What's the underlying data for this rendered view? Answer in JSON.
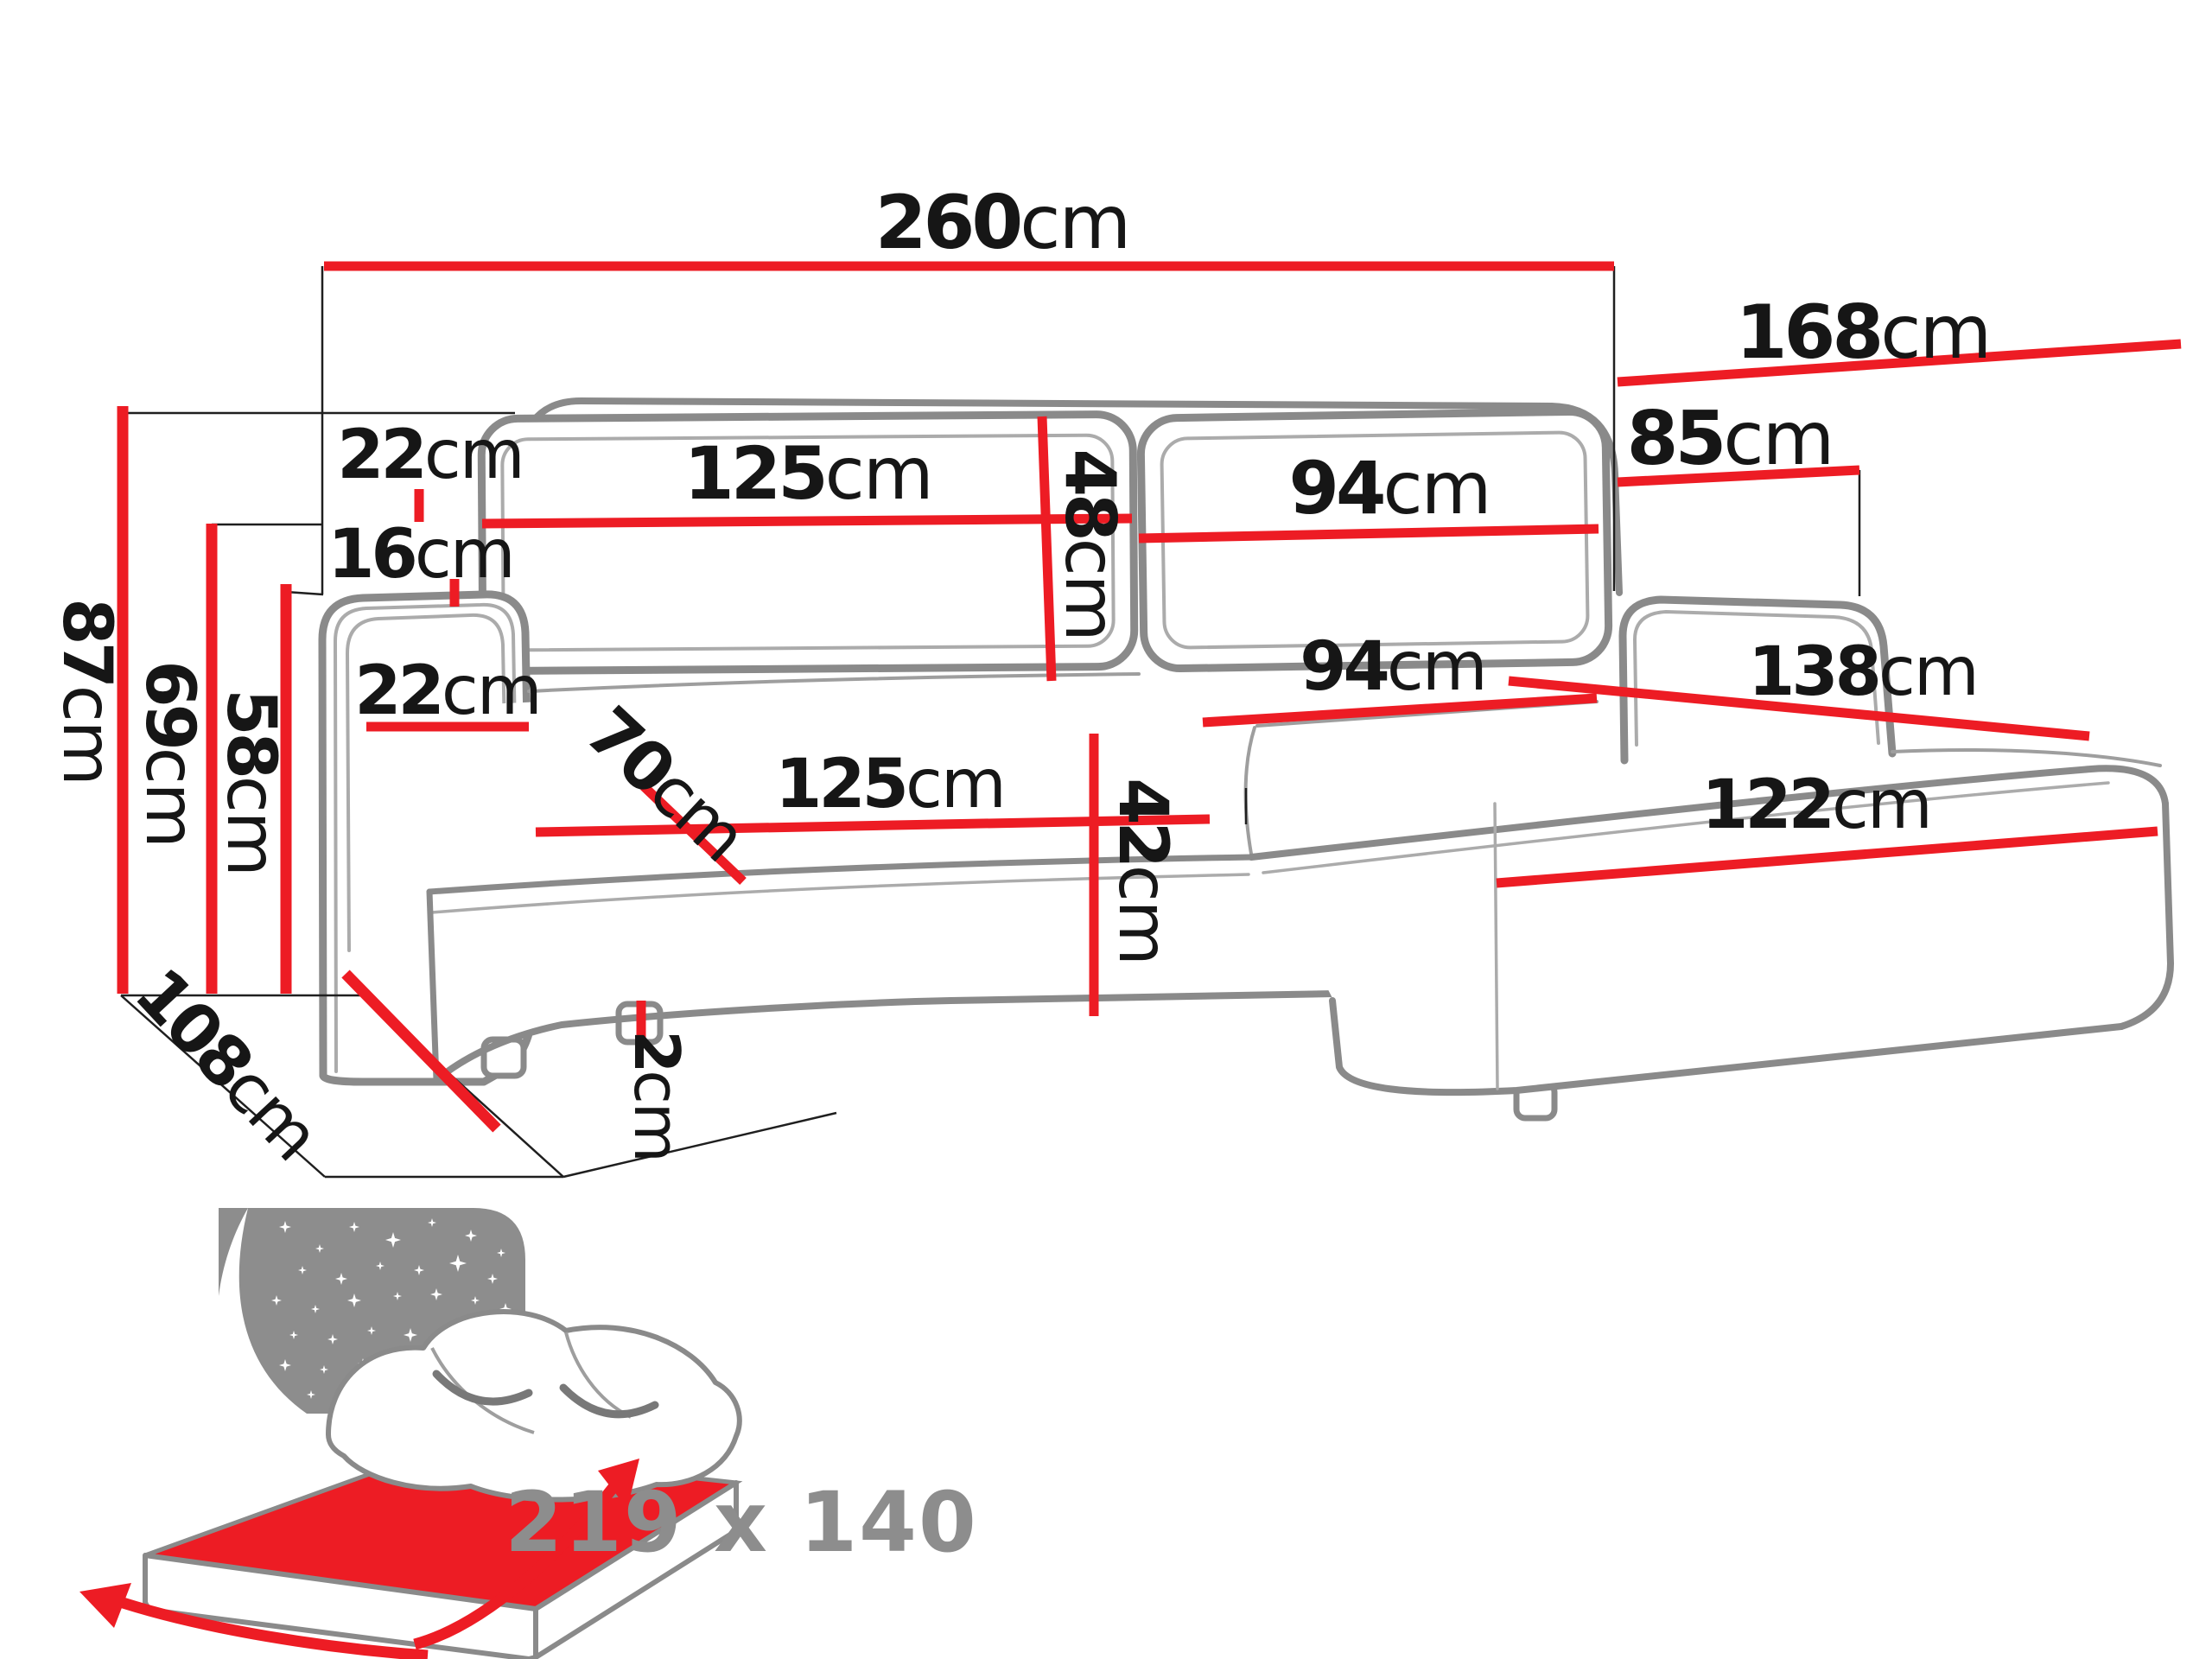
{
  "colors": {
    "dimension_red": "#ed1c24",
    "sofa_outline_gray": "#8a8a8a",
    "inner_line_gray": "#ababab",
    "construction_black": "#1f1f1f",
    "label_black": "#161616",
    "icon_gray": "#8d8d8d"
  },
  "dimensions": {
    "total_width": {
      "value": "260",
      "unit": "cm"
    },
    "chaise_total_depth": {
      "value": "168",
      "unit": "cm"
    },
    "backrest_right_height": {
      "value": "85",
      "unit": "cm"
    },
    "back_cushion_left_width": {
      "value": "125",
      "unit": "cm"
    },
    "back_cushion_height": {
      "value": "48",
      "unit": "cm"
    },
    "back_cushion_right_width": {
      "value": "94",
      "unit": "cm"
    },
    "back_cushion_thickness": {
      "value": "22",
      "unit": "cm"
    },
    "armrest_to_cushion_gap": {
      "value": "16",
      "unit": "cm"
    },
    "armrest_width": {
      "value": "22",
      "unit": "cm"
    },
    "seat_depth": {
      "value": "70",
      "unit": "cm"
    },
    "seat_left_width": {
      "value": "125",
      "unit": "cm"
    },
    "seat_right_width": {
      "value": "94",
      "unit": "cm"
    },
    "chaise_diagonal_length": {
      "value": "138",
      "unit": "cm"
    },
    "chaise_front_width": {
      "value": "122",
      "unit": "cm"
    },
    "seat_front_height": {
      "value": "42",
      "unit": "cm"
    },
    "foot_height": {
      "value": "2",
      "unit": "cm"
    },
    "total_height": {
      "value": "87",
      "unit": "cm"
    },
    "backrest_height": {
      "value": "69",
      "unit": "cm"
    },
    "armrest_height": {
      "value": "58",
      "unit": "cm"
    },
    "total_depth": {
      "value": "108",
      "unit": "cm"
    }
  },
  "sleeping_area": {
    "label": "219 x 140"
  }
}
